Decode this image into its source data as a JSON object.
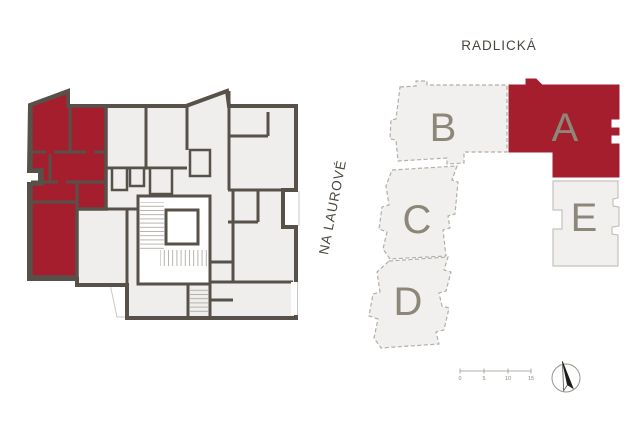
{
  "colors": {
    "highlight_red": "#a41e2d",
    "wall_dark": "#57514a",
    "room_fill": "#efeeec",
    "block_fill": "#f1f0ee",
    "block_outline_dashed": "#b3aea7",
    "block_outline_solid": "#c6c2bc",
    "block_label": "#8d8779",
    "street_label": "#4a453e",
    "scale_color": "#9a958d"
  },
  "floor_plan": {
    "has_highlighted_unit": true
  },
  "site_plan": {
    "streets": {
      "top": "RADLICKÁ",
      "left": "NA LAUROVÉ"
    },
    "blocks": [
      {
        "label": "B",
        "highlighted": false
      },
      {
        "label": "A",
        "highlighted": true
      },
      {
        "label": "C",
        "highlighted": false
      },
      {
        "label": "D",
        "highlighted": false
      },
      {
        "label": "E",
        "highlighted": false
      }
    ],
    "scale_bar": {
      "ticks": [
        "0",
        "5",
        "10",
        "15"
      ]
    },
    "compass": {
      "icon": "north-arrow"
    }
  }
}
